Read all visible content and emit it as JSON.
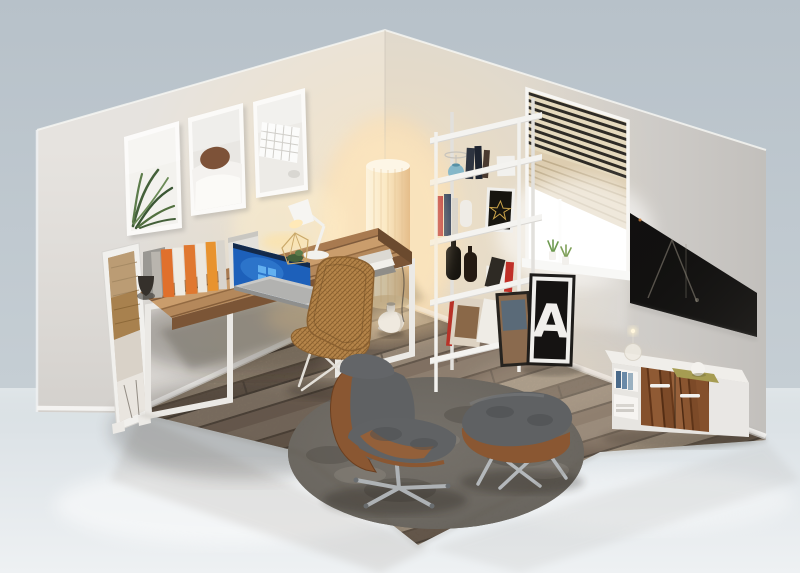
{
  "scene": {
    "title": "3D isometric cutaway render of a home office room",
    "poster": {
      "letter": "A"
    },
    "colors": {
      "backdrop_top": "#b7c1c9",
      "backdrop_bottom": "#ccd4d9",
      "ground": "#dfe5e8",
      "wall_left": "#e6e3df",
      "wall_right": "#dad7d3",
      "warm_glow": "#ffe9bf",
      "floor_dark": "#5d4b3c",
      "floor_light": "#a8957f",
      "desk_wood": "#a6713f",
      "frame_white": "#f2f1ee",
      "rug": "#6e6962",
      "wicker": "#b5854a",
      "cushion": "#5f6163",
      "walnut": "#7c4a28",
      "tv": "#121110",
      "laptop_screen": "#2d7dd8",
      "poster_bg": "#151312",
      "poster_letter": "#f1efec",
      "accent_orange": "#e0702c",
      "accent_red": "#bb3030",
      "accent_blue_vase": "#7ab2c8",
      "plant_green": "#44603a"
    },
    "objects": [
      "left wall with three framed prints (plant, bedroom, keyboard)",
      "standing mirror leaning on wall",
      "wooden desk on white steel frame legs",
      "row of books with bookends",
      "laptop with blue screen",
      "white task lamp",
      "geometric glass terrarium",
      "stack of books",
      "wicker chair",
      "glowing paper floor lamp with white vase",
      "white ladder shelf with books, blue vase, black bottles and prints",
      "window with venetian blinds and sill plants",
      "letter-A poster leaning below window",
      "wall-mounted black TV",
      "white sideboard with walnut drawer fronts",
      "glass dome lamp, olive mat and white sphere on sideboard",
      "round shaggy gray rug",
      "lounge chair with ottoman",
      "plank wood floor"
    ]
  }
}
